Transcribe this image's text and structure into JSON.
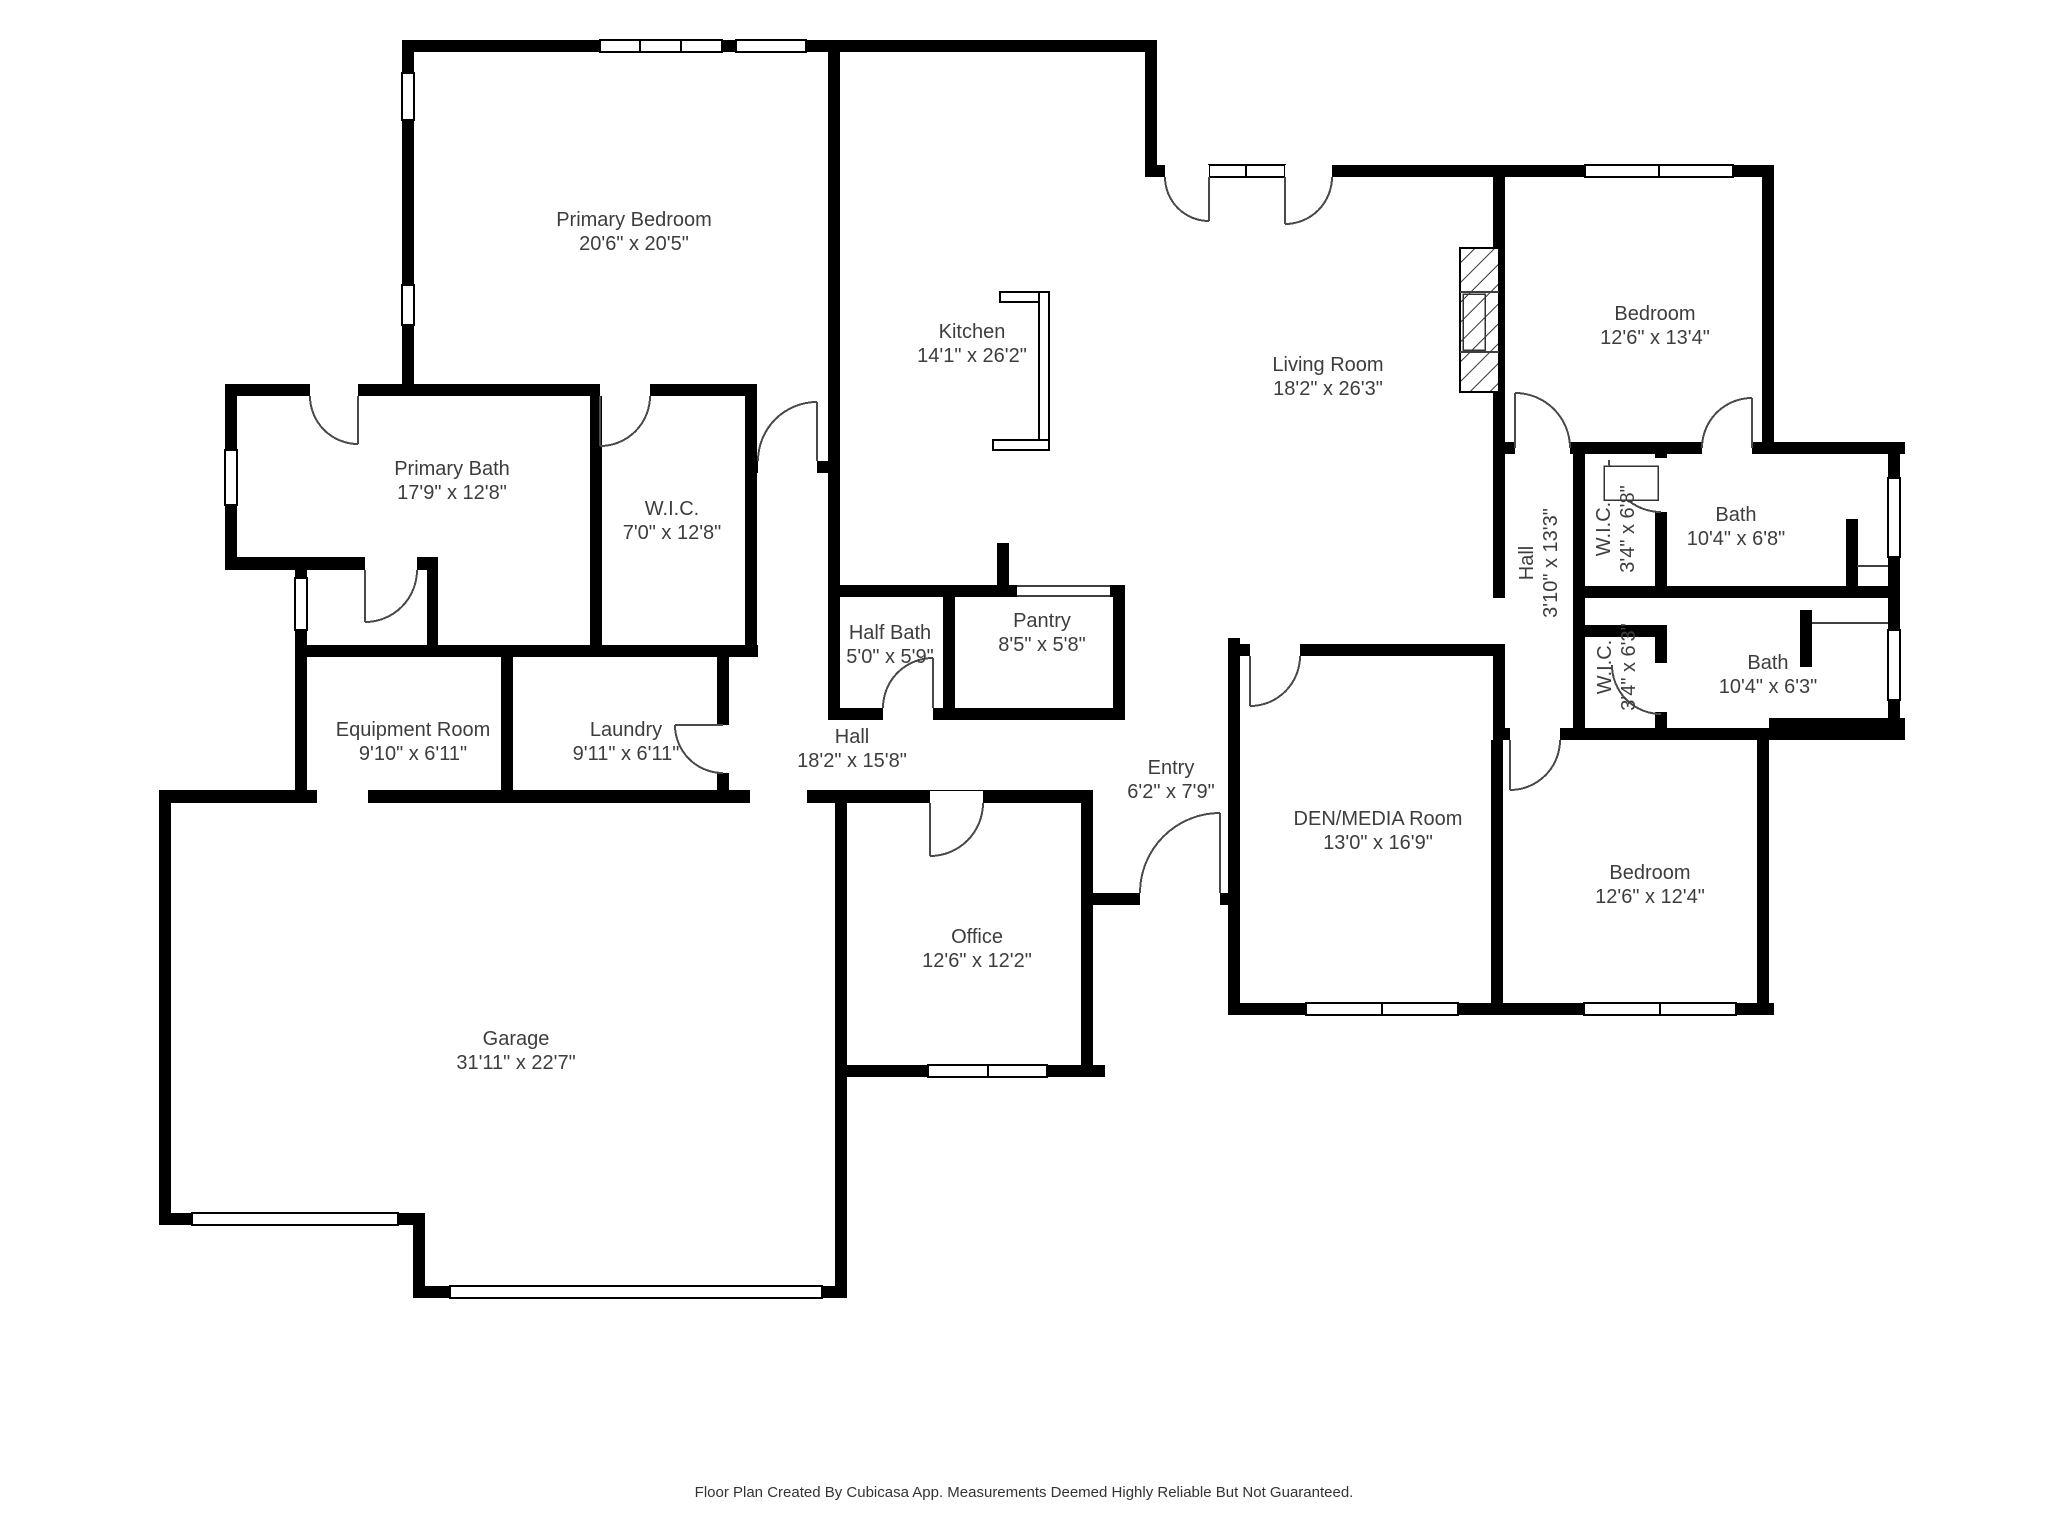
{
  "colors": {
    "wall": "#000000",
    "text": "#3d3d3d",
    "background": "#ffffff"
  },
  "rooms": {
    "primary_bedroom": {
      "name": "Primary Bedroom",
      "dims": "20'6\" x 20'5\""
    },
    "kitchen": {
      "name": "Kitchen",
      "dims": "14'1\" x 26'2\""
    },
    "living_room": {
      "name": "Living Room",
      "dims": "18'2\" x 26'3\""
    },
    "bedroom_top_right": {
      "name": "Bedroom",
      "dims": "12'6\" x 13'4\""
    },
    "primary_bath": {
      "name": "Primary Bath",
      "dims": "17'9\" x 12'8\""
    },
    "wic_primary": {
      "name": "W.I.C.",
      "dims": "7'0\" x 12'8\""
    },
    "hall_bedrooms": {
      "name": "Hall",
      "dims": "3'10\" x 13'3\""
    },
    "wic_upper": {
      "name": "W.I.C.",
      "dims": "3'4\" x 6'8\""
    },
    "bath_upper": {
      "name": "Bath",
      "dims": "10'4\" x 6'8\""
    },
    "wic_lower": {
      "name": "W.I.C.",
      "dims": "3'4\" x 6'3\""
    },
    "bath_lower": {
      "name": "Bath",
      "dims": "10'4\" x 6'3\""
    },
    "half_bath": {
      "name": "Half Bath",
      "dims": "5'0\" x 5'9\""
    },
    "pantry": {
      "name": "Pantry",
      "dims": "8'5\" x 5'8\""
    },
    "equipment_room": {
      "name": "Equipment Room",
      "dims": "9'10\" x 6'11\""
    },
    "laundry": {
      "name": "Laundry",
      "dims": "9'11\" x 6'11\""
    },
    "hall_main": {
      "name": "Hall",
      "dims": "18'2\" x 15'8\""
    },
    "entry": {
      "name": "Entry",
      "dims": "6'2\" x 7'9\""
    },
    "den": {
      "name": "DEN/MEDIA Room",
      "dims": "13'0\" x 16'9\""
    },
    "bedroom_bottom_right": {
      "name": "Bedroom",
      "dims": "12'6\" x 12'4\""
    },
    "office": {
      "name": "Office",
      "dims": "12'6\" x 12'2\""
    },
    "garage": {
      "name": "Garage",
      "dims": "31'11\" x 22'7\""
    }
  },
  "footer": {
    "text": "Floor Plan Created By Cubicasa App. Measurements Deemed Highly Reliable But Not Guaranteed."
  }
}
